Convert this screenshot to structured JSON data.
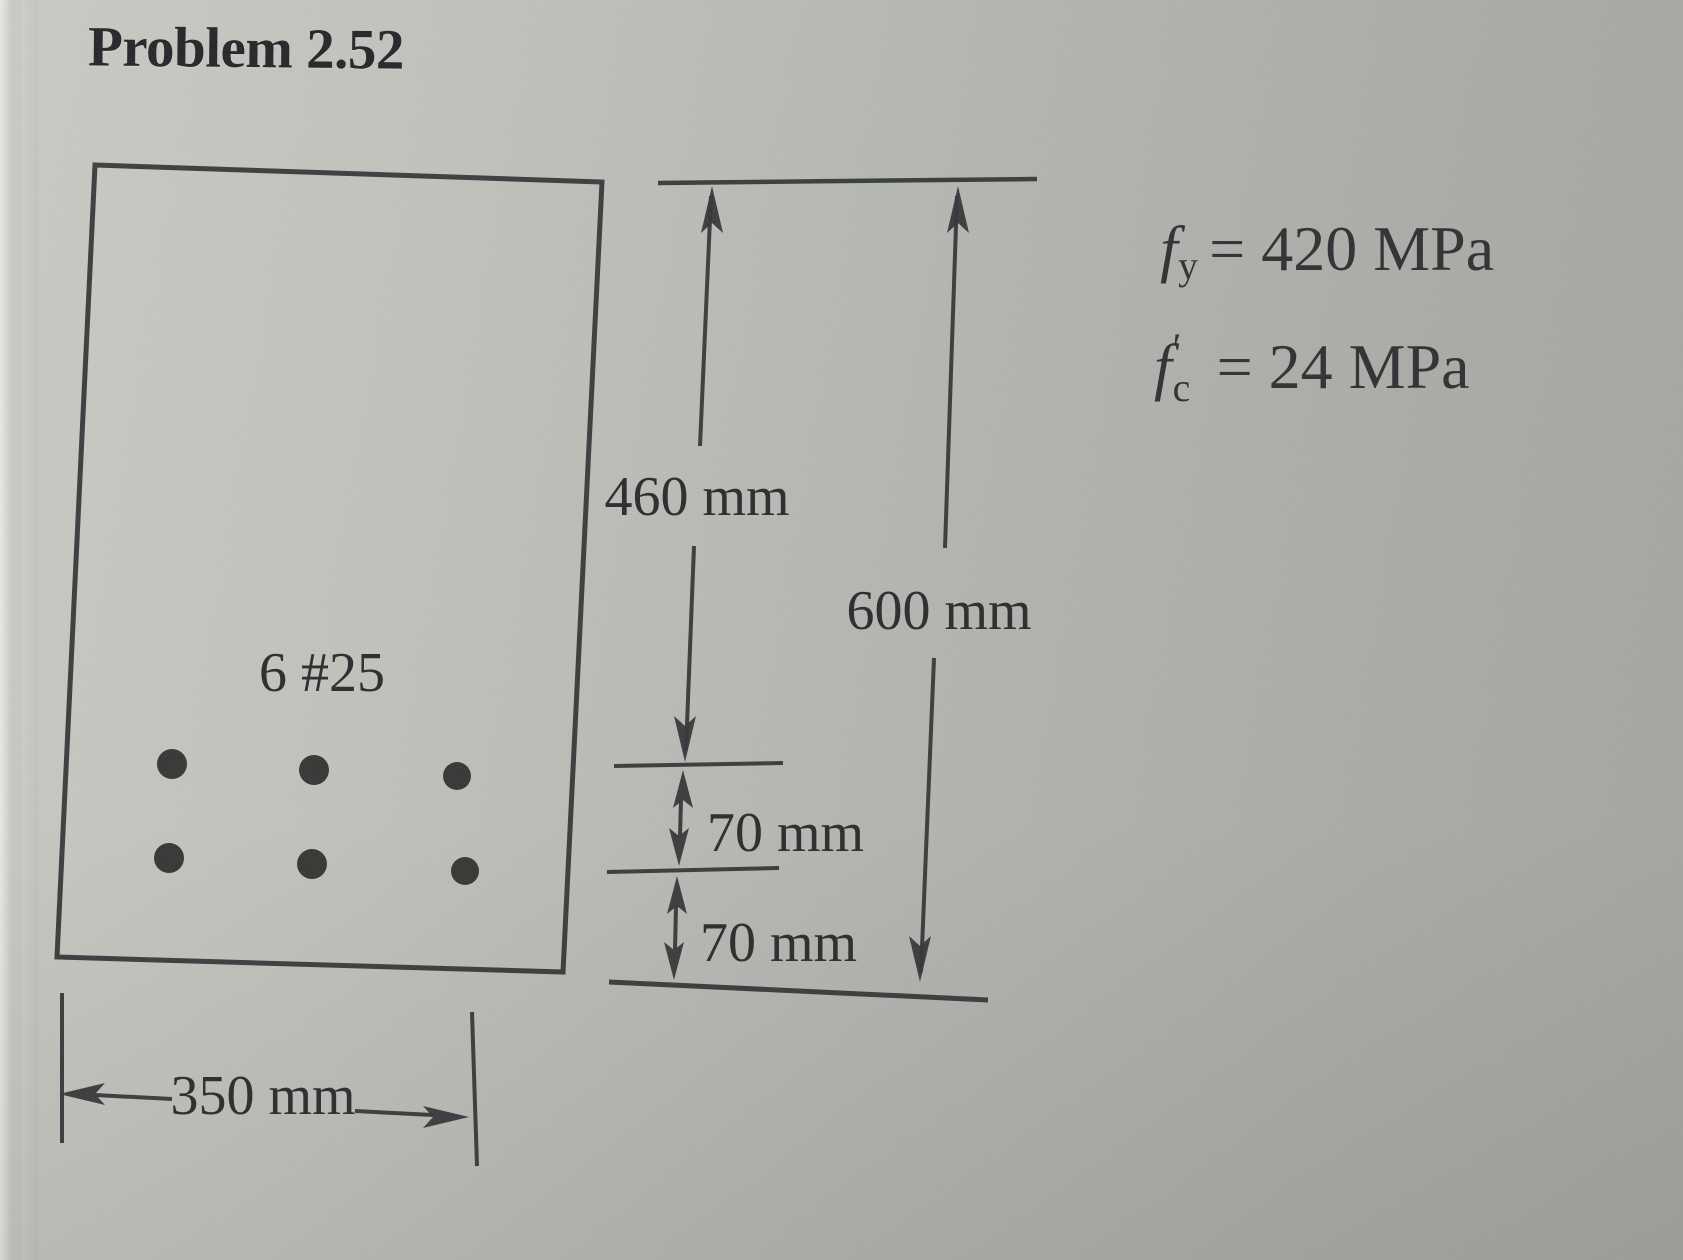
{
  "page": {
    "title": "Problem 2.52"
  },
  "beam": {
    "section_label": "6 #25",
    "rebar_count": 6,
    "rebar_rows": 2,
    "rebar_per_row": 3
  },
  "dimensions": {
    "width_label": "350 mm",
    "effective_depth_label": "460 mm",
    "overall_depth_label": "600 mm",
    "bar_layer_gap_label": "70 mm",
    "bottom_layer_gap_label": "70 mm"
  },
  "material_properties": [
    {
      "symbol": "f",
      "subscript": "y",
      "prime": "",
      "rhs": "= 420 MPa"
    },
    {
      "symbol": "f",
      "subscript": "c",
      "prime": "′",
      "rhs": "= 24 MPa"
    }
  ],
  "colors": {
    "ink": "#2d2f31",
    "paper": "#b4b6b1"
  }
}
